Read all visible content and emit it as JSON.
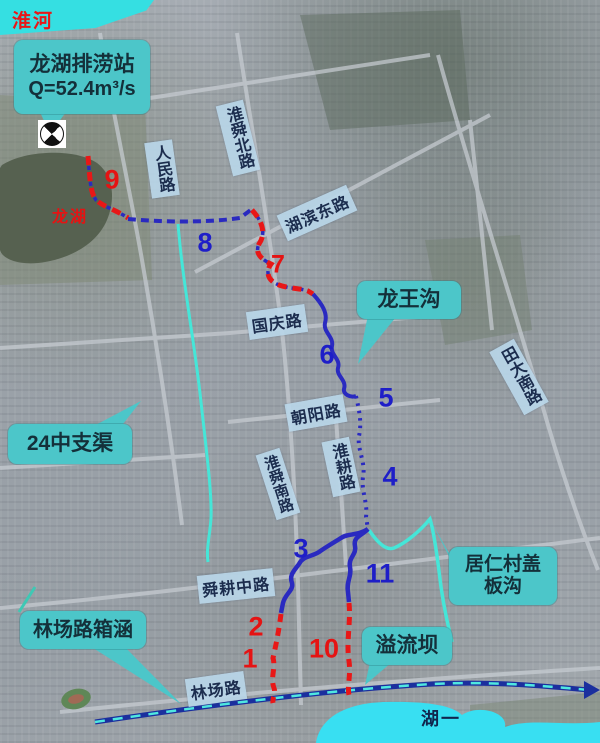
{
  "map": {
    "river_label": "淮河",
    "lake_label": "龙湖",
    "bottom_lake_label": "湖一",
    "pump_callout": {
      "line1": "龙湖排涝站",
      "line2": "Q=52.4m³/s"
    },
    "callouts": {
      "longwanggou": {
        "text": "龙王沟"
      },
      "branch24": {
        "text": "24中支渠"
      },
      "juren": {
        "line1": "居仁村盖",
        "line2": "板沟"
      },
      "linchang_box_culvert": {
        "text": "林场路箱涵"
      },
      "yiliuba": {
        "text": "溢流坝"
      }
    },
    "roads": {
      "renmin": "人民路",
      "huaishun_north": "淮舜北路",
      "hubin_east": "湖滨东路",
      "guoqing": "国庆路",
      "chaoyang": "朝阳路",
      "huaigeng": "淮耕路",
      "huaishun_south": "淮舜南路",
      "shungeng_middle": "舜耕中路",
      "linchang": "林场路",
      "tianda_south": "田大南路"
    },
    "route_markers": {
      "m1": "1",
      "m2": "2",
      "m3": "3",
      "m4": "4",
      "m5": "5",
      "m6": "6",
      "m7": "7",
      "m8": "8",
      "m9": "9",
      "m10": "10",
      "m11": "11"
    },
    "colors": {
      "callout_teal": "#4cc6c9",
      "road_label_blue": "#b8d6e8",
      "marker_red": "#e51313",
      "marker_blue": "#1e1ec8",
      "route_red": "#e81717",
      "route_blue": "#2a2ac0",
      "channel_cyan": "#45e6d8",
      "river_cyan": "#35dfe2",
      "bottom_lake_cyan": "#38dff2"
    }
  }
}
